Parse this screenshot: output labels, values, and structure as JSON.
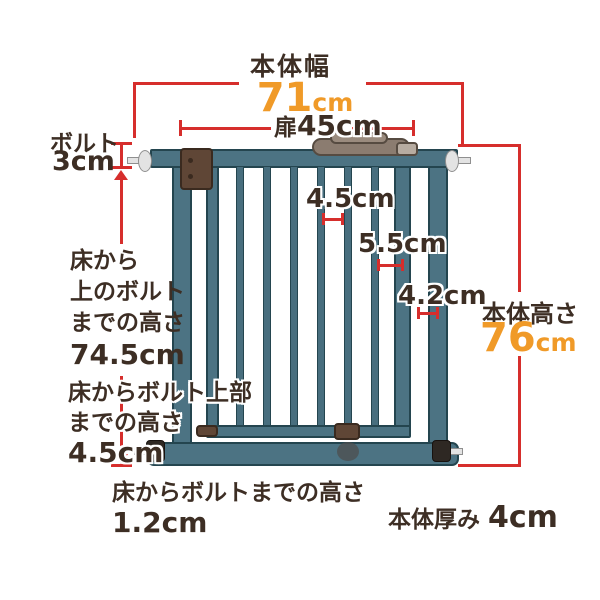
{
  "colors": {
    "dimension_red": "#d62e2c",
    "value_orange": "#f09a28",
    "text_dark": "#3d2e24",
    "gate_teal": "#4c7383",
    "gate_edge": "#24454f",
    "hinge_brown": "#5f4636",
    "bolt_silver": "#e3e3e3"
  },
  "top": {
    "width_title": "本体幅",
    "width_value": "71",
    "width_unit": "cm",
    "door_label": "扉",
    "door_value": "45cm"
  },
  "left": {
    "bolt_label": "ボルト",
    "bolt_value": "3cm",
    "upper_line1": "床から",
    "upper_line2": "上のボルト",
    "upper_line3": "までの高さ",
    "upper_value": "74.5cm",
    "mid_line1": "床からボルト上部",
    "mid_line2": "までの高さ",
    "mid_value": "4.5cm",
    "floor_label": "床からボルトまでの高さ",
    "floor_value": "1.2cm"
  },
  "right": {
    "height_label": "本体高さ",
    "height_value": "76",
    "height_unit": "cm",
    "depth_label": "本体厚み",
    "depth_value": "4cm"
  },
  "gaps": {
    "bar_gap": "4.5cm",
    "door_gap": "5.5cm",
    "frame_gap": "4.2cm"
  }
}
